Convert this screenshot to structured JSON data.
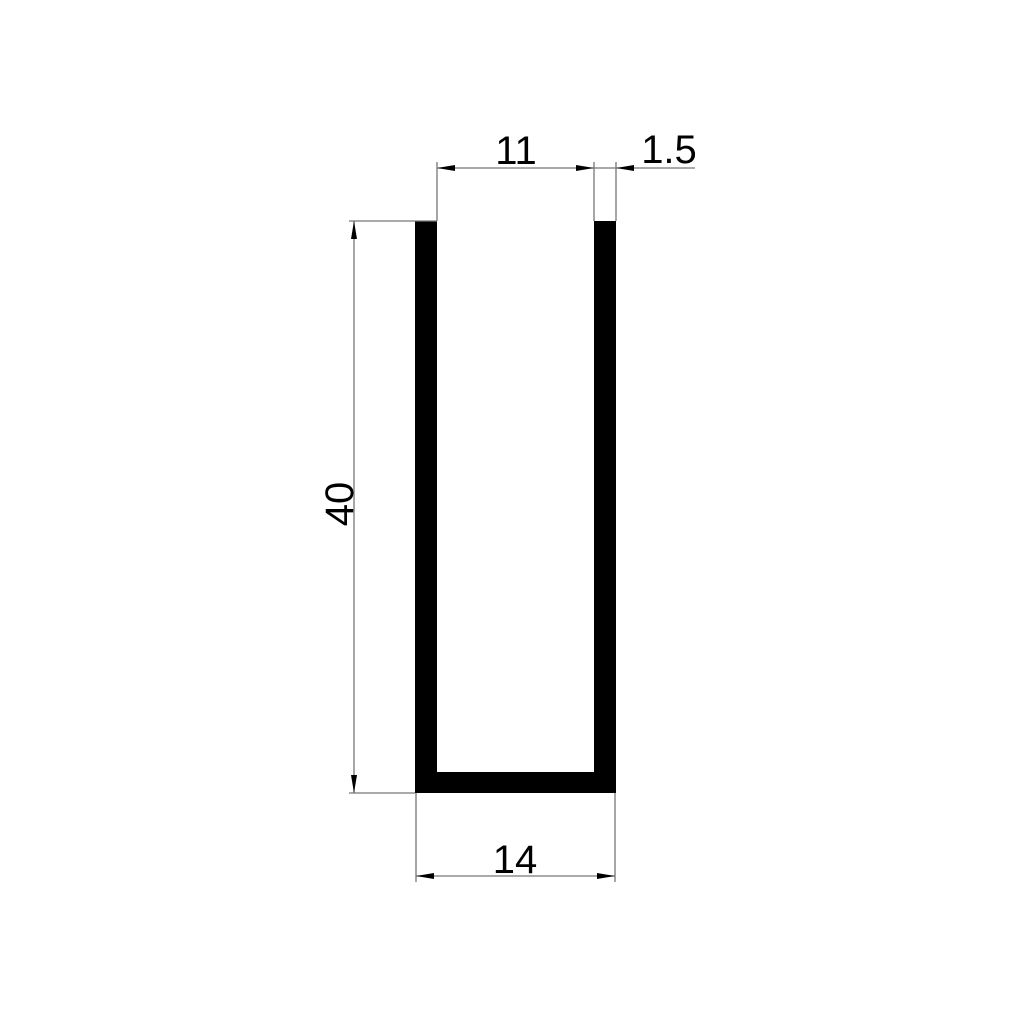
{
  "canvas": {
    "background": "#ffffff"
  },
  "drawing": {
    "profile_shape": "u-channel-cross-section",
    "colors": {
      "profile_fill": "#000000",
      "dimension_line": "#777777",
      "text": "#000000"
    },
    "dimensions": {
      "inner_width": "11",
      "wall_thickness": "1.5",
      "height": "40",
      "outer_width": "14"
    }
  }
}
